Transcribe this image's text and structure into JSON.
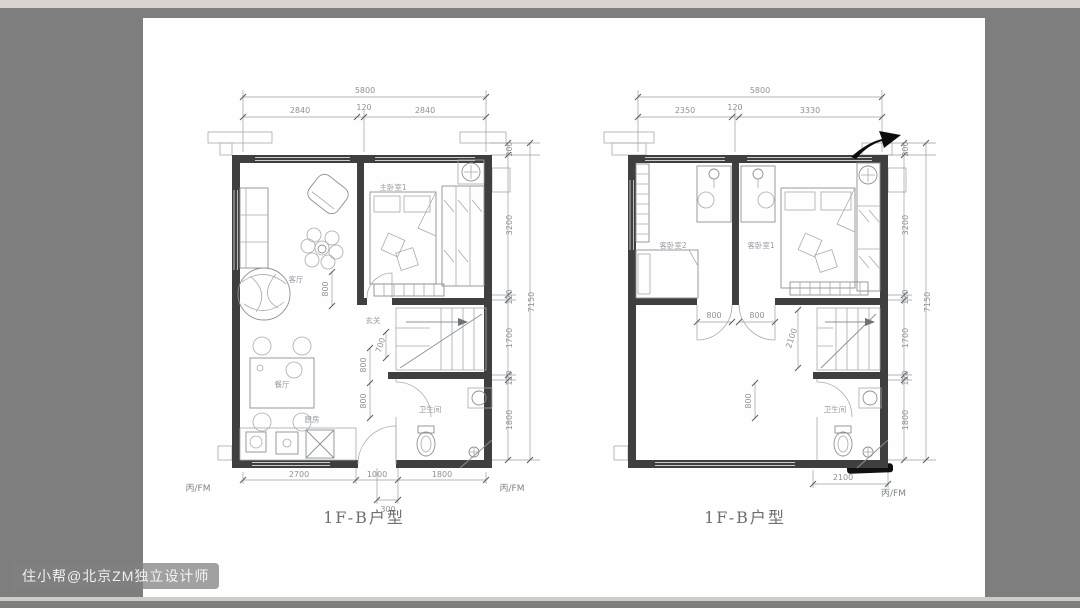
{
  "page": {
    "watermark": "住小帮@北京ZM独立设计师"
  },
  "colors": {
    "wall": "#3f3f3f",
    "thin_line": "#a7abae",
    "dimension": "#8e9296",
    "background": "#7e7e7e",
    "paper": "#fefefe",
    "annotation": "#0c0c0c"
  },
  "plans": [
    {
      "title": "1F-B户型",
      "rooms": {
        "living": "客厅",
        "dining": "餐厅",
        "bedroom": "主卧室1",
        "entry": "玄关",
        "kitchen": "厨房",
        "bath": "卫生间"
      },
      "dims": {
        "top_total": "5800",
        "top_left": "2840",
        "top_mid": "120",
        "top_right": "2840",
        "right_offset": "200",
        "right_1": "3200",
        "right_2": "120",
        "right_3": "1700",
        "right_4": "120",
        "right_5": "1800",
        "right_total": "7150",
        "bottom_1": "2700",
        "bottom_2": "1000",
        "bottom_3": "1800",
        "bottom_offset": "300",
        "fm_left": "丙/FM",
        "fm_right": "丙/FM",
        "living_depth": "800",
        "entry_width": "700",
        "hall_1": "800",
        "hall_2": "800"
      }
    },
    {
      "title": "1F-B户型",
      "rooms": {
        "bedroom2": "客卧室2",
        "bedroom1": "客卧室1",
        "bath": "卫生间"
      },
      "dims": {
        "top_total": "5800",
        "top_left": "2350",
        "top_mid": "120",
        "top_right": "3330",
        "right_offset": "200",
        "right_1": "3200",
        "right_2": "120",
        "right_3": "1700",
        "right_4": "120",
        "right_5": "1800",
        "right_total": "7150",
        "door_1": "800",
        "door_2": "800",
        "stair_depth": "2100",
        "hall_1": "800",
        "bottom_1": "2100",
        "fm_right": "丙/FM"
      }
    }
  ]
}
